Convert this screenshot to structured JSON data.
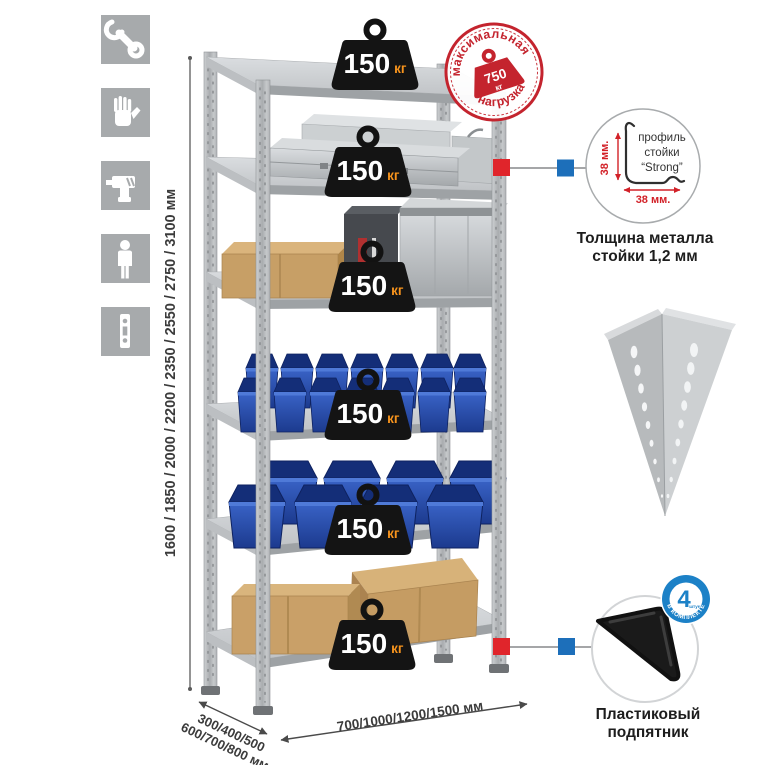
{
  "colors": {
    "accent_red": "#c4242e",
    "connector_red": "#e0252b",
    "connector_blue": "#1d6fba",
    "icon_gray": "#a7aaac",
    "bin_blue": "#2550b4",
    "metal_gray": "#c3c6c8",
    "cardboard": "#c9a068",
    "badge_blue": "#1c81c7"
  },
  "sidebar": {
    "icons": [
      {
        "name": "wrench-icon"
      },
      {
        "name": "gloves-icon"
      },
      {
        "name": "drill-icon"
      },
      {
        "name": "person-icon"
      },
      {
        "name": "rack-post-icon"
      }
    ]
  },
  "dimensions": {
    "height": "1600 / 1850 / 2000 / 2200 / 2350 / 2550 / 2750 / 3100 мм",
    "depth_line1": "300/400/500",
    "depth_line2": "600/700/800 мм",
    "width": "700/1000/1200/1500 мм"
  },
  "shelf_load": {
    "value": "150",
    "unit": "кг"
  },
  "stamp": {
    "line_top": "максимальная",
    "line_bottom": "нагрузка",
    "value": "750",
    "unit": "кг"
  },
  "profile_detail": {
    "label_line1": "профиль",
    "label_line2": "стойки",
    "label_line3": "“Strong”",
    "dim_vertical": "38 мм.",
    "dim_horizontal": "38 мм.",
    "caption_line1": "Толщина металла",
    "caption_line2": "стойки 1,2 мм"
  },
  "foot_detail": {
    "badge_value": "4",
    "badge_units": "штуки",
    "badge_arc": "В КОМПЛЕКТЕ",
    "caption_line1": "Пластиковый",
    "caption_line2": "подпятник"
  }
}
